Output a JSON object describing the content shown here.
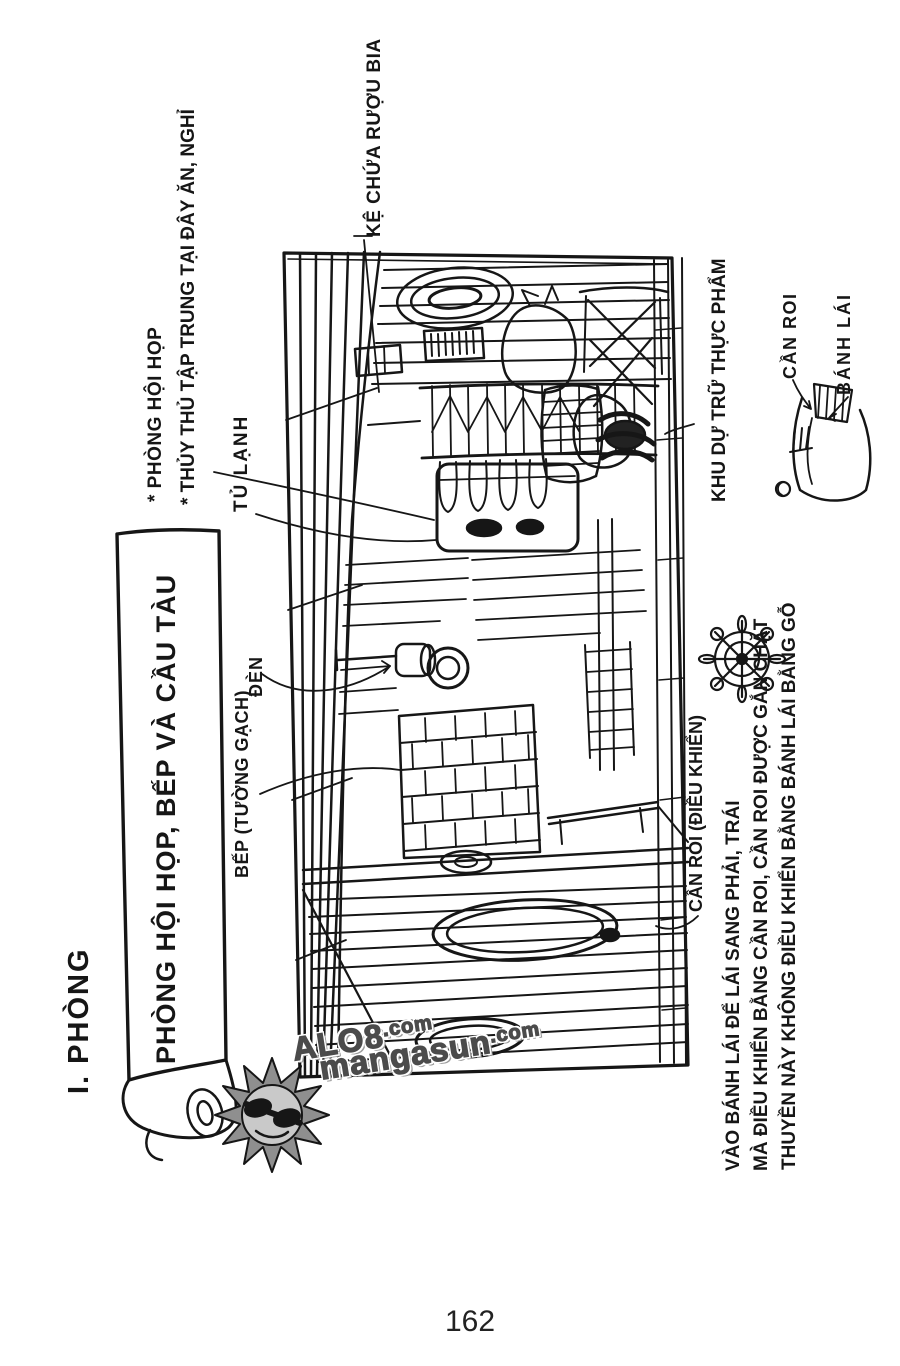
{
  "page": {
    "section_title": "I. PHÒNG",
    "page_number": "162"
  },
  "banner": {
    "title": "PHÒNG HỘI HỌP, BẾP VÀ CẦU TÀU"
  },
  "notes": {
    "lines": [
      "* PHÒNG HỘI HỌP",
      "* THỦY THỦ TẬP TRUNG TẠI ĐÂY ĂN, NGHỈ"
    ]
  },
  "labels": {
    "beer_shelf": "KỆ CHỨA RƯỢU BIA",
    "fridge": "TỦ LẠNH",
    "food_storage": "KHU DỰ TRỮ THỰC PHẨM",
    "tiller": "CẦN ROI",
    "rudder": "BÁNH LÁI",
    "lamp": "ĐÈN",
    "stove": "BẾP (TƯỜNG GẠCH)",
    "tiller_control": "CẦN ROI (ĐIỀU KHIỂN)"
  },
  "caption": {
    "lines": [
      "THUYỀN NÀY KHÔNG ĐIỀU KHIỂN BẰNG BÁNH LÁI BẰNG GỖ",
      "MÀ ĐIỀU KHIỂN BẰNG CẦN ROI, CẦN ROI ĐƯỢC GẮN CHẶT",
      "VÀO BÁNH LÁI ĐỂ LÁI SANG PHẢI, TRÁI"
    ]
  },
  "watermark": {
    "brand1": "ALO8",
    "tld1": ".com",
    "brand2": "mangasun",
    "tld2": ".com"
  },
  "icons": {
    "helm": "ships-wheel-icon",
    "sun": "sun-logo-icon"
  },
  "colors": {
    "ink": "#161616",
    "paper": "#ffffff",
    "watermark_gray": "#4b4b4b"
  }
}
